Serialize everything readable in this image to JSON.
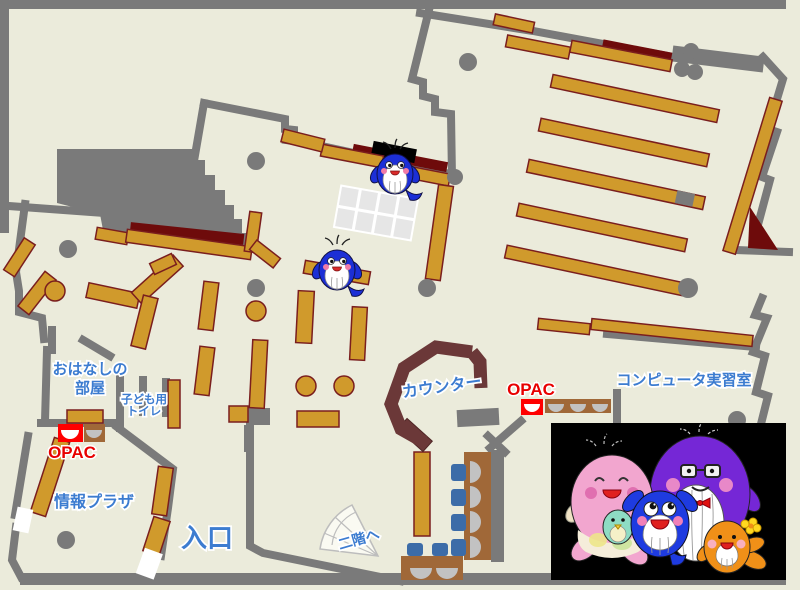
{
  "labels": {
    "story_room_1": "おはなしの",
    "story_room_2": "部屋",
    "kids_toilet_1": "子ども用",
    "kids_toilet_2": "トイレ",
    "opac_left": "OPAC",
    "opac_right": "OPAC",
    "info_plaza": "情報プラザ",
    "entrance": "入口",
    "stairs_up": "二階へ",
    "counter": "カウンター",
    "computer_room": "コンピュータ実習室"
  },
  "colors": {
    "floor": "#EBEBDB",
    "wall_gray": "#7A7A7A",
    "shelf_tan": "#D09A2C",
    "shelf_border": "#7A1E1E",
    "dark_red_area": "#6E0B0B",
    "counter_brown": "#6B3838",
    "desk_brown": "#A06838",
    "chair_blue": "#3C6CA8",
    "label_blue": "#3C7CD0",
    "label_red": "#E80000",
    "photo_background": "#000000"
  },
  "mascots": {
    "small_whale": "blue whale mascot",
    "family": "whale family: pink mother with teal baby, blue child, purple father with glasses and bow tie, orange child with flower"
  }
}
